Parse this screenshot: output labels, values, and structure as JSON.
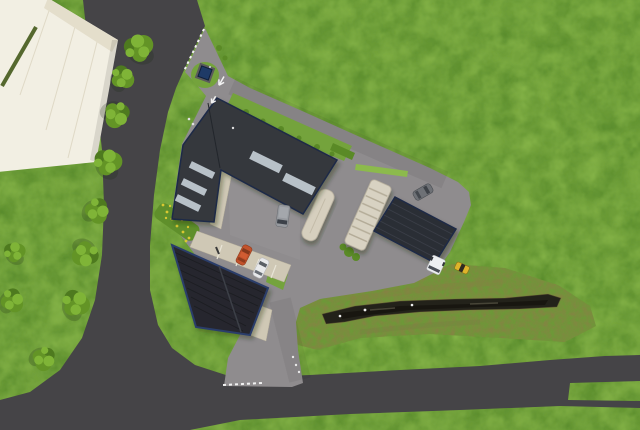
{
  "scene": {
    "type": "aerial-3d-site-plan-render",
    "view": "top-down orthographic bird's-eye view",
    "setting": "rural commercial plot in green fields with access roads, parking yard, retention pond and tree row"
  },
  "colors": {
    "grass_base": "#74a33c",
    "grass_dark": "#578a2b",
    "grass_light": "#8cba4c",
    "rough_grass": "#6d9838",
    "brown_patch": "#8a7f46",
    "road_asphalt": "#454447",
    "pavement": "#8f8c8e",
    "walkway_beige": "#cfc8b5",
    "parking_divider": "#e8e4d6",
    "white_roof": "#f2efe3",
    "white_roof_seam": "#dfd9c6",
    "roof_dark": "#34373d",
    "roof_solar": "#26282e",
    "roof_edge_blue": "#2b3d6b",
    "roof_seam": "#24262c",
    "skylight": "#b8c1c8",
    "skylight_edge": "#8f99a1",
    "canopy_beige": "#d8d2c2",
    "canopy_rib": "#b4ac98",
    "unit_beige": "#d6cfbe",
    "hedge_green": "#55682e",
    "bush_green": "#5a8a26",
    "flowerbed_green": "#5f8f2b",
    "flower_yellow": "#d9c832",
    "tree_dark": "#4e7a1f",
    "tree_mid": "#639426",
    "tree_light": "#7fb437",
    "water_dark": "#23221a",
    "water_deep": "#15140e",
    "water_glint": "#5a5747",
    "marking_white": "#f2f2f2",
    "utility_navy": "#1e3a66",
    "van_gray": "#96999e",
    "car_orange": "#c2522b",
    "car_white": "#e8e9eb",
    "car_gray": "#6e7176",
    "truck_white": "#edeff1",
    "digger_yellow": "#ddb42b",
    "window_dark": "#3c4149"
  },
  "site": {
    "buildings": [
      {
        "id": "white-warehouse",
        "desc": "large cream industrial hall at top-left with roof seams and green strip"
      },
      {
        "id": "main-hall",
        "desc": "dark L-shaped main hall with two long rooflights and three short rooflights"
      },
      {
        "id": "solar-hall",
        "desc": "south hall with near-black photovoltaic roof and blue trim, two panels"
      },
      {
        "id": "long-outbuilding",
        "desc": "long dark storage/carport building on east side with loading truck"
      },
      {
        "id": "ribbed-canopy",
        "desc": "beige ribbed shelter canopy in yard"
      },
      {
        "id": "small-unit",
        "desc": "small beige rounded unit beside courtyard"
      },
      {
        "id": "utility-cabinet",
        "desc": "navy blue transformer cabinet on grass island at site entrance"
      }
    ],
    "vehicles": [
      {
        "id": "gray-van",
        "location": "center courtyard"
      },
      {
        "id": "orange-car",
        "location": "parking bay south of main hall"
      },
      {
        "id": "white-car",
        "location": "parking bay south of main hall"
      },
      {
        "id": "gray-car",
        "location": "east driveway"
      },
      {
        "id": "white-truck-cab",
        "location": "docked at south corner of long outbuilding"
      },
      {
        "id": "yellow-mini-digger",
        "location": "on grass east of outbuilding"
      }
    ],
    "roads": {
      "public_road": "dark asphalt road curving from top edge down the left side to a junction, main road running along the bottom to a forked end at the right edge",
      "site_access": "light gray paved entrance, driveway and parking yard with exit leg to the main road"
    },
    "landscape": {
      "tree_row_count": 10,
      "pond": "elongated dark retention pond in rough grass berm, lower right",
      "flower_strip": "yellow wildflower bed west of the halls",
      "bird_count": 4
    },
    "markings": {
      "dotted_boundary_lines": 2,
      "pavement_arrows": 2,
      "parking_bays": 4
    }
  }
}
